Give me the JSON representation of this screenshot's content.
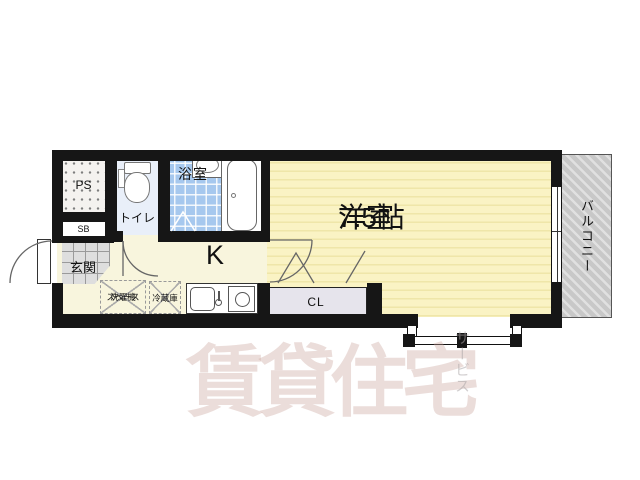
{
  "plan": {
    "type": "apartment-floorplan-1K",
    "rooms": {
      "main_room": {
        "name": "洋室",
        "size": "7.5帖"
      },
      "kitchen": {
        "abbr": "K"
      },
      "bathroom": {
        "name": "浴室"
      },
      "toilet": {
        "name": "トイレ"
      },
      "entrance": {
        "name": "玄関"
      },
      "balcony": {
        "name": "バルコニー"
      },
      "closet": {
        "abbr": "CL"
      },
      "pipe_space": {
        "abbr": "PS"
      },
      "shoe_box": {
        "abbr": "SB"
      },
      "washer_space": {
        "line1": "洗濯機",
        "line2": "スペース"
      },
      "fridge": {
        "name": "冷蔵庫"
      }
    },
    "watermark": {
      "main": "賃貸住宅",
      "sub": "サービス"
    },
    "colors": {
      "wall": "#161616",
      "main_room_fill": "#FAF3C4",
      "main_room_stripe": "#EFE6A9",
      "kitchen_fill": "#F8F5DD",
      "bath_tile": "#A6C8EE",
      "toilet_fill": "#E9EFF9",
      "entrance_fill": "#DEDEDE",
      "closet_fill": "#E6E4EC",
      "balcony_fill": "#C8C8C8",
      "watermark": "rgba(203,166,158,0.38)"
    }
  }
}
